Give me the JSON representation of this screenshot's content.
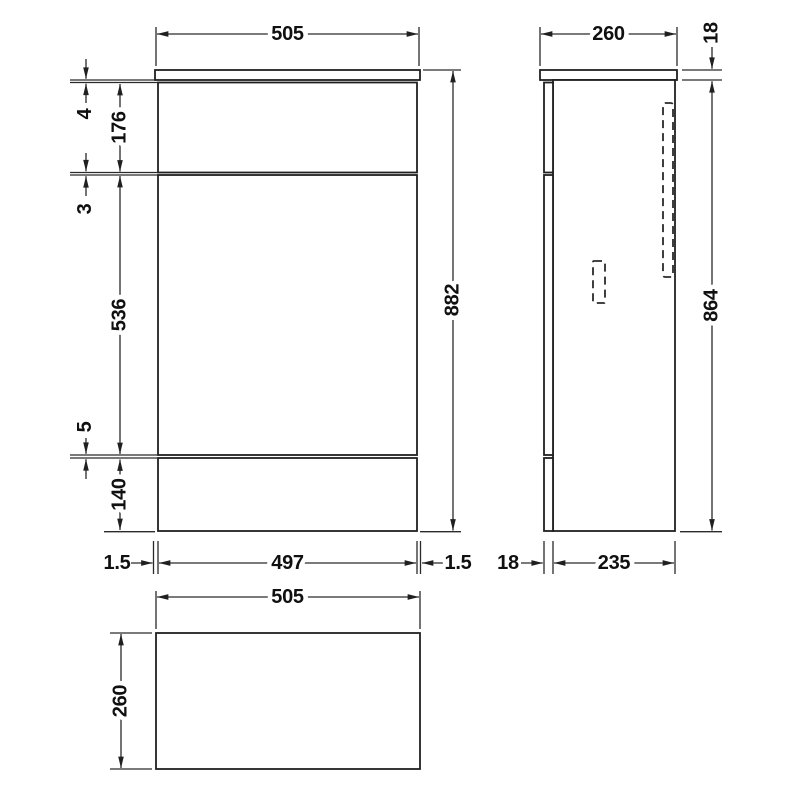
{
  "drawing": {
    "colors": {
      "line": "#202020",
      "background": "#ffffff"
    },
    "views": {
      "front": {
        "worktop_width": "505",
        "overall_height": "882",
        "worktop_gap": "4",
        "upper_panel_height": "176",
        "upper_seam_gap": "3",
        "middle_panel_height": "536",
        "lower_seam_gap": "5",
        "plinth_height": "140",
        "left_overhang": "1.5",
        "carcass_width": "497",
        "right_overhang": "1.5"
      },
      "side": {
        "worktop_depth": "260",
        "worktop_thickness": "18",
        "body_height": "864",
        "front_panel_thickness": "18",
        "carcass_depth": "235"
      },
      "plan": {
        "worktop_width": "505",
        "worktop_depth": "260"
      }
    }
  }
}
